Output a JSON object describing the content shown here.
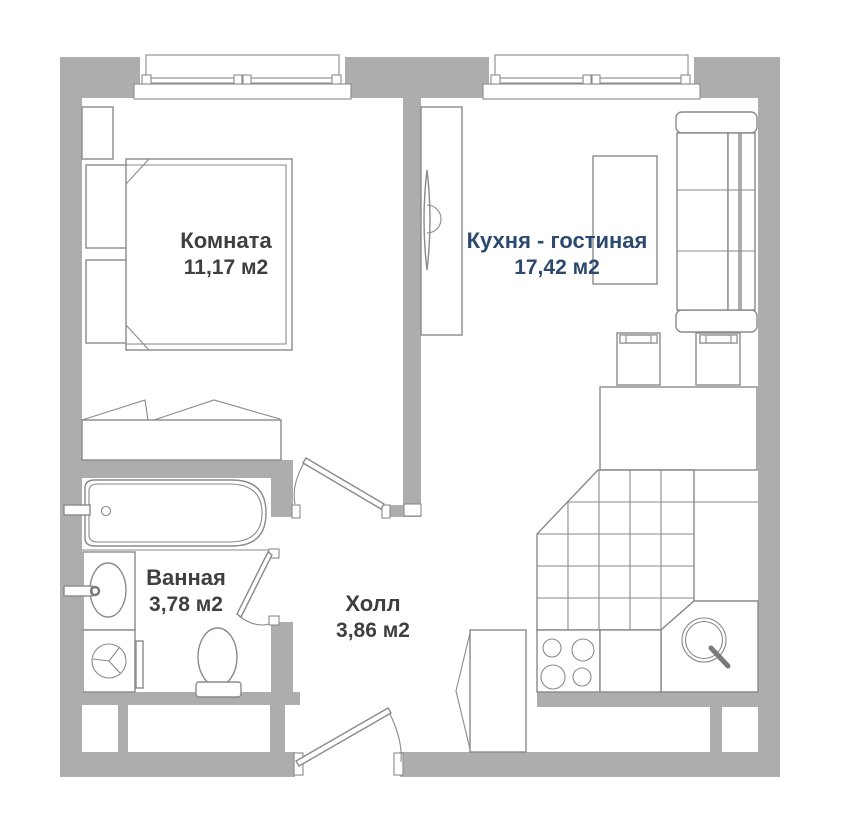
{
  "plan": {
    "title": "apartment-floor-plan",
    "rooms": [
      {
        "name": "Комната",
        "area": "11,17 м2"
      },
      {
        "name": "Кухня - гостиная",
        "area": "17,42 м2"
      },
      {
        "name": "Ванная",
        "area": "3,78 м2"
      },
      {
        "name": "Холл",
        "area": "3,86 м2"
      }
    ],
    "colors": {
      "wall": "#adadad",
      "line": "#8a8a8a",
      "label_text": "#3f3f3f",
      "kitchen_label_text": "#2c4a70",
      "background": "#ffffff",
      "sink_handle": "#7a7a7a"
    }
  }
}
